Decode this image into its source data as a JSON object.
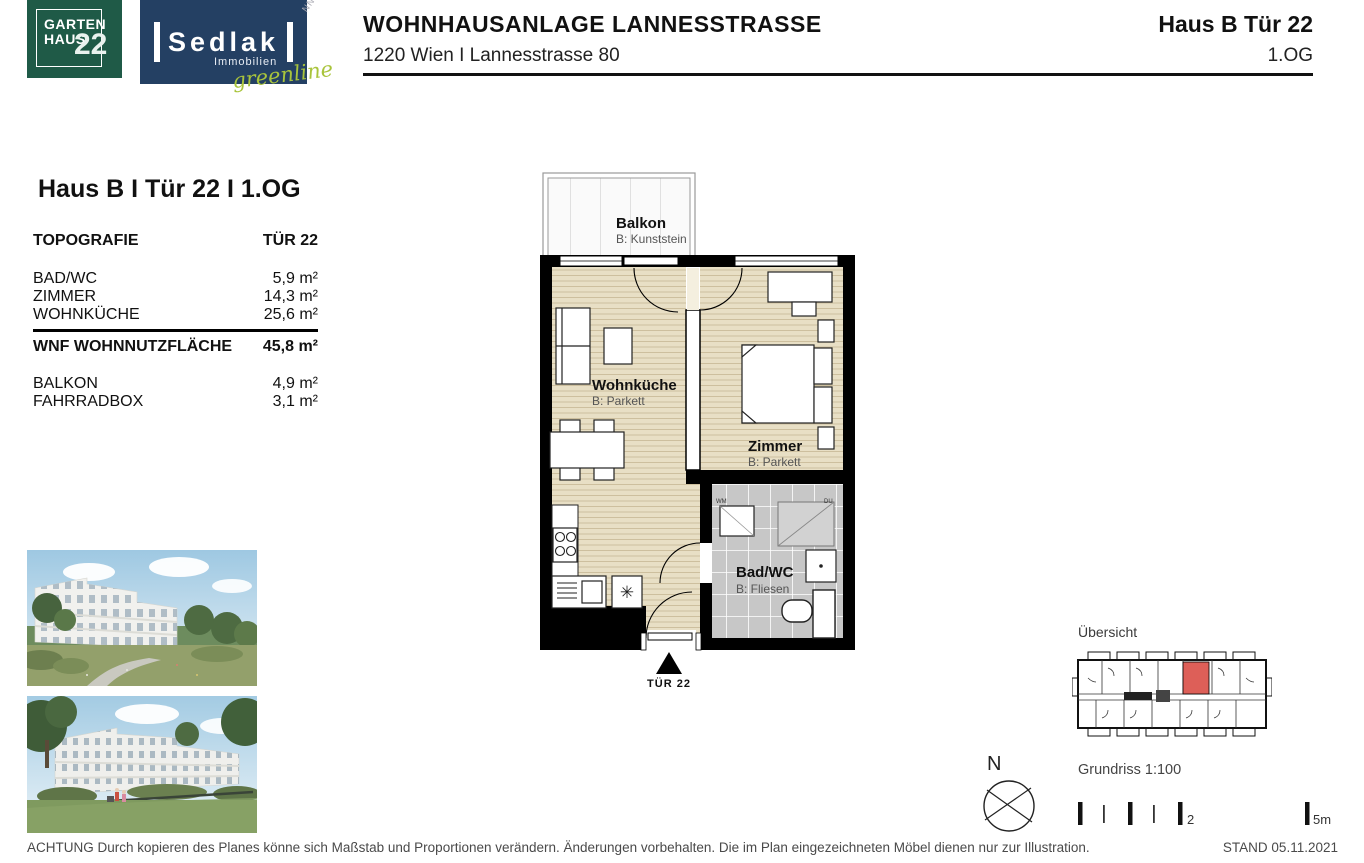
{
  "header": {
    "logo_gartenhaus": {
      "line1": "GARTEN",
      "line2": "HAUS",
      "number": "22"
    },
    "logo_sedlak": {
      "name": "Sedlak",
      "sub": "Immobilien",
      "script": "greenline"
    },
    "watermark": "NNECT",
    "title": "WOHNHAUSANLAGE LANNESSTRASSE",
    "address": "1220 Wien I Lannesstrasse 80",
    "unit": "Haus B Tür 22",
    "floor": "1.OG"
  },
  "panel": {
    "heading": "Haus B I Tür 22 I 1.OG",
    "table_header": {
      "left": "TOPOGRAFIE",
      "right": "TÜR 22"
    },
    "rooms": [
      {
        "label": "BAD/WC",
        "area": "5,9 m²"
      },
      {
        "label": "ZIMMER",
        "area": "14,3 m²"
      },
      {
        "label": "WOHNKÜCHE",
        "area": "25,6 m²"
      }
    ],
    "total": {
      "label": "WNF WOHNNUTZFLÄCHE",
      "area": "45,8 m²"
    },
    "extras": [
      {
        "label": "BALKON",
        "area": "4,9 m²"
      },
      {
        "label": "FAHRRADBOX",
        "area": "3,1 m²"
      }
    ]
  },
  "floorplan": {
    "balkon": {
      "name": "Balkon",
      "floor": "B: Kunststein"
    },
    "wohnkueche": {
      "name": "Wohnküche",
      "floor": "B: Parkett"
    },
    "zimmer": {
      "name": "Zimmer",
      "floor": "B: Parkett"
    },
    "badwc": {
      "name": "Bad/WC",
      "floor": "B: Fliesen"
    },
    "entry_label": "TÜR 22",
    "wm_label": "WM",
    "du_label": "DU"
  },
  "overview": {
    "label": "Übersicht"
  },
  "map_tools": {
    "compass_n": "N",
    "scale_label": "Grundriss 1:100",
    "scale_mid": "2",
    "scale_end": "5m"
  },
  "footer": {
    "disclaimer": "ACHTUNG Durch kopieren des Planes könne sich Maßstab und Proportionen verändern. Änderungen vorbehalten. Die im Plan eingezeichneten Möbel dienen nur zur Illustration.",
    "stand": "STAND 05.11.2021"
  },
  "colors": {
    "logo_green": "#1f5a47",
    "logo_navy": "#244063",
    "greenline_green": "#a9c43c",
    "parquet": "#e8dfc5",
    "parquet_stripe": "#cdbf9e",
    "tile_gray": "#c7c7c7",
    "wall_black": "#000000",
    "highlight_red": "#dd5f58"
  }
}
